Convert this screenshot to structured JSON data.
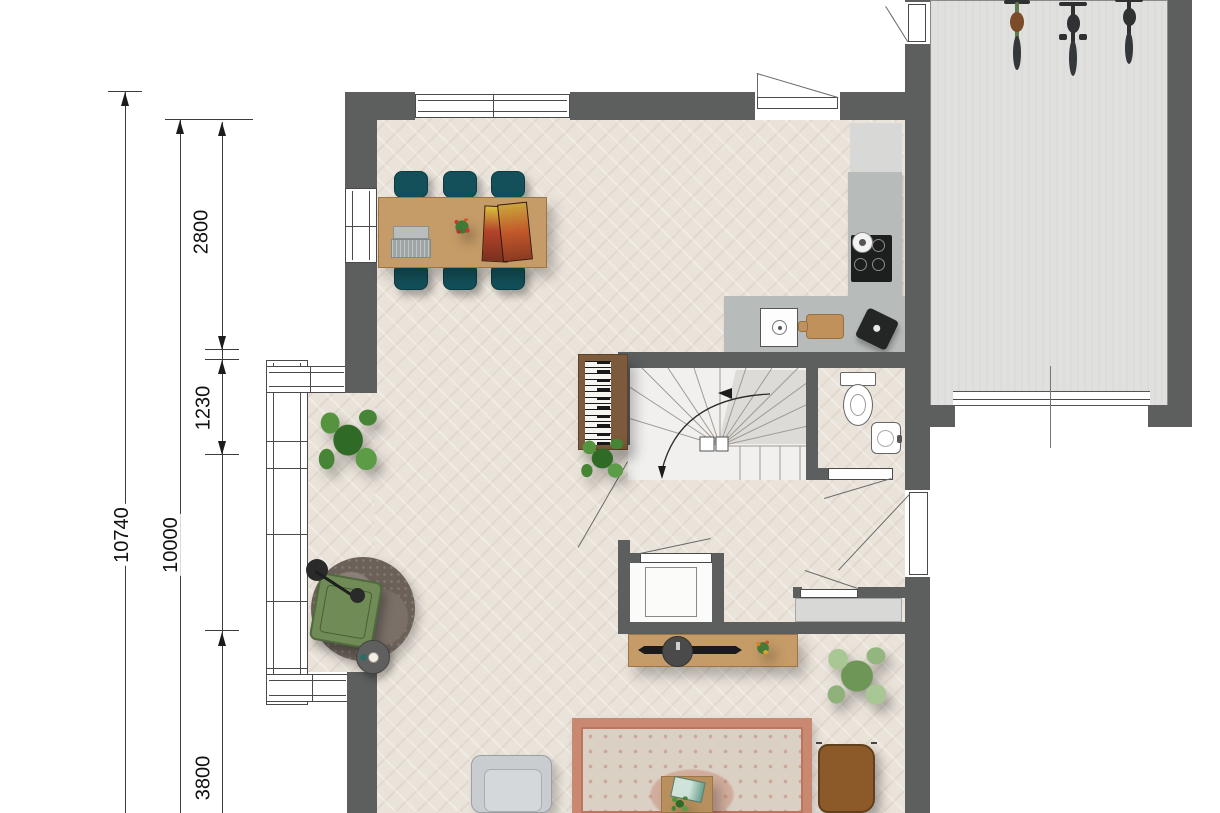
{
  "dimension_labels": {
    "overall": "10740",
    "inner": "10000",
    "top_segment": "2800",
    "bay_segment": "1230",
    "bottom_segment": "3800"
  },
  "colors": {
    "wall": "#5c5f5e",
    "floor": "#eae3da",
    "garage_floor": "#e0e0df",
    "counter": "#b7bbba",
    "cabinet": "#d8d9d7",
    "appliance_black": "#1d1f1f",
    "chair_teal": "#135059",
    "wood": "#c59c68",
    "armchair_green": "#708b56",
    "lounge_chair_brown": "#8c5a28",
    "sofa_gray": "#c9cdd0",
    "rug_border": "#c98970",
    "rug_field": "#dbd0c4",
    "round_rug": "#6b6159",
    "plant_dark_green": "#478536",
    "plant_sage_green": "#a9c795",
    "stair_bg": "#f1f0ee",
    "stair_wedge": "#dcdbd7"
  },
  "objects": [
    "dining-table",
    "dining-chairs",
    "laptop",
    "flower-bouquet",
    "magazines",
    "kitchen-counter",
    "cooktop",
    "kettle",
    "sink",
    "cutting-board",
    "coffee-machine",
    "tall-cabinet",
    "spiral-staircase",
    "piano",
    "toilet",
    "wash-basin",
    "storage-cabinet",
    "hall-closet",
    "bay-window",
    "window",
    "entrance-door",
    "garage-door",
    "side-door",
    "potted-plant",
    "floor-lamp",
    "armchair-green",
    "round-rug",
    "side-table",
    "sideboard",
    "soundbar",
    "decor-disc",
    "area-rug",
    "coffee-table",
    "sofa",
    "lounge-chair-brown",
    "bicycles"
  ]
}
